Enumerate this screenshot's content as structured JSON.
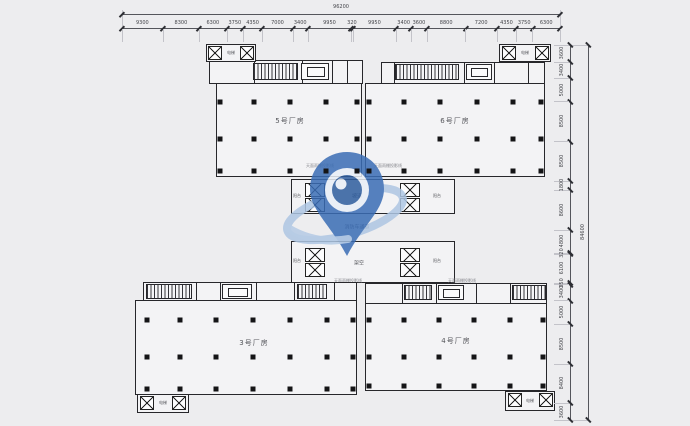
{
  "drawing": {
    "buildings": [
      {
        "label": "5号厂房"
      },
      {
        "label": "6号厂房"
      },
      {
        "label": "3号厂房"
      },
      {
        "label": "4号厂房"
      }
    ],
    "labels": {
      "fire_lane": "消防车通道",
      "ramp": "坡道",
      "stilt": "架空",
      "balcony": "阳台",
      "elevator": "电梯",
      "canopy_note": "天面雨棚投影线"
    }
  },
  "dimensions": {
    "top": {
      "total": "96200",
      "segments": [
        "9300",
        "8300",
        "6300",
        "3750",
        "4350",
        "7000",
        "3400",
        "9950",
        "320",
        "9950",
        "3400",
        "3600",
        "8800",
        "7200",
        "4350",
        "3750",
        "6300"
      ]
    },
    "right": {
      "total": "84600",
      "segments": [
        "3600",
        "3400",
        "5000",
        "8500",
        "8500",
        "1800",
        "8600",
        "4800",
        "320",
        "6100",
        "350",
        "3400",
        "5000",
        "8500",
        "8400",
        "3600"
      ]
    }
  },
  "colors": {
    "line": "#27272b",
    "dim_text": "#45464b",
    "label_text": "#54555a",
    "background": "#ededef",
    "watermark_primary": "#3a6db5",
    "watermark_light": "#aec6e3"
  }
}
